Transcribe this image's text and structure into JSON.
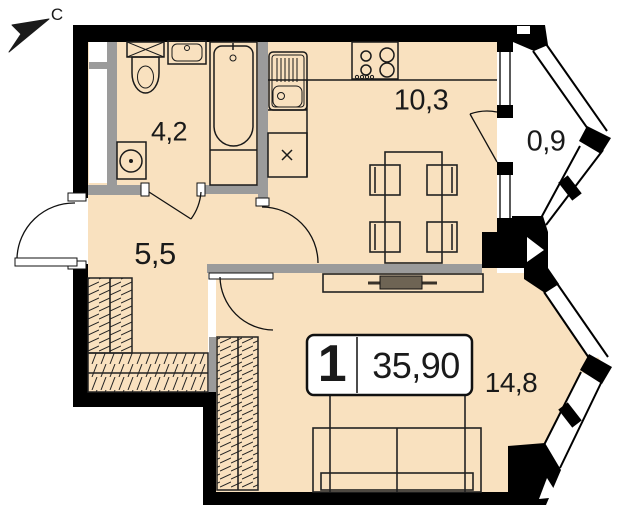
{
  "north": {
    "label": "С"
  },
  "badge": {
    "rooms": "1",
    "total_area": "35,90"
  },
  "rooms": [
    {
      "id": "bathroom",
      "area": "4,2"
    },
    {
      "id": "kitchen-living",
      "area": "10,3"
    },
    {
      "id": "balcony",
      "area": "0,9"
    },
    {
      "id": "hallway",
      "area": "5,5"
    },
    {
      "id": "living-room",
      "area": "14,8"
    }
  ],
  "colors": {
    "floor": "#F9E1BF",
    "walls": "#000000",
    "partitions": "#9B9B9B",
    "balcony_floor": "#FFFFFF",
    "furniture_dark": "#6E6454"
  }
}
